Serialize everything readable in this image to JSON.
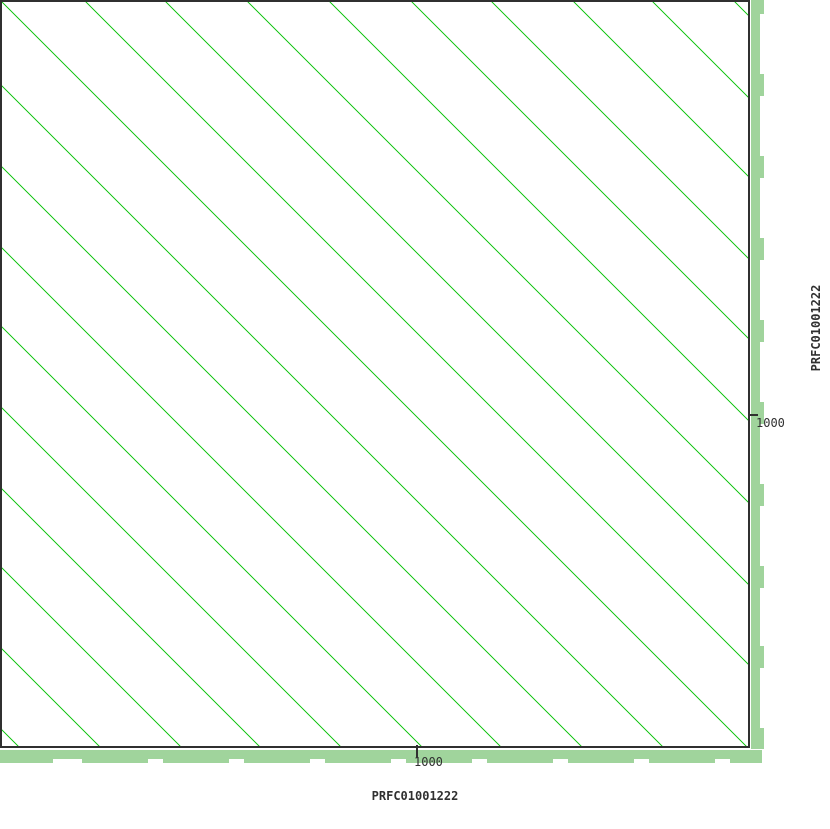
{
  "figure": {
    "background": "#ffffff",
    "width_px": 830,
    "height_px": 829
  },
  "axes": {
    "x": {
      "title": "PRFC01001222",
      "tick_label": "1000",
      "tick_value": 1000
    },
    "y": {
      "title": "PRFC01001222",
      "tick_label": "1000",
      "tick_value": 1000
    }
  },
  "chart_data": {
    "type": "scatter",
    "subtype": "self-alignment-dotplot",
    "x_sequence": "PRFC01001222",
    "y_sequence": "PRFC01001222",
    "x_ticks": [
      1000
    ],
    "y_ticks": [
      1000
    ],
    "x_tick_px": 417,
    "y_tick_px": 415,
    "plot_px": {
      "width": 750,
      "height": 749
    },
    "scale_bp_per_px": 2.4,
    "approx_repeat_period_px": 81,
    "approx_repeat_period_bp": 195,
    "diagonals_px_offsets": [
      -728,
      -647,
      -566,
      -487,
      -406,
      -325,
      -246,
      -165,
      -84,
      0,
      84,
      164,
      246,
      328,
      410,
      490,
      572,
      651,
      733
    ],
    "colors": {
      "match_line": "#1ec81e",
      "coverage_band": "#a0d49c",
      "frame": "#303030",
      "text": "#303030",
      "background": "#ffffff"
    },
    "coverage_right": {
      "base": {
        "x": 751,
        "width": 9,
        "y0": 0,
        "y1": 749
      },
      "bumps_width": 13,
      "bump_segments_y": [
        [
          0,
          14
        ],
        [
          74,
          96
        ],
        [
          156,
          178
        ],
        [
          238,
          260
        ],
        [
          320,
          342
        ],
        [
          402,
          424
        ],
        [
          484,
          506
        ],
        [
          566,
          588
        ],
        [
          646,
          668
        ],
        [
          728,
          749
        ]
      ]
    },
    "coverage_bottom": {
      "base": {
        "y": 750,
        "height": 9,
        "x0": 0,
        "x1": 762
      },
      "bumps_height": 13,
      "bump_segments_x": [
        [
          0,
          53
        ],
        [
          82,
          148
        ],
        [
          163,
          229
        ],
        [
          244,
          310
        ],
        [
          325,
          391
        ],
        [
          406,
          472
        ],
        [
          487,
          553
        ],
        [
          568,
          634
        ],
        [
          649,
          715
        ],
        [
          730,
          762
        ]
      ]
    }
  }
}
